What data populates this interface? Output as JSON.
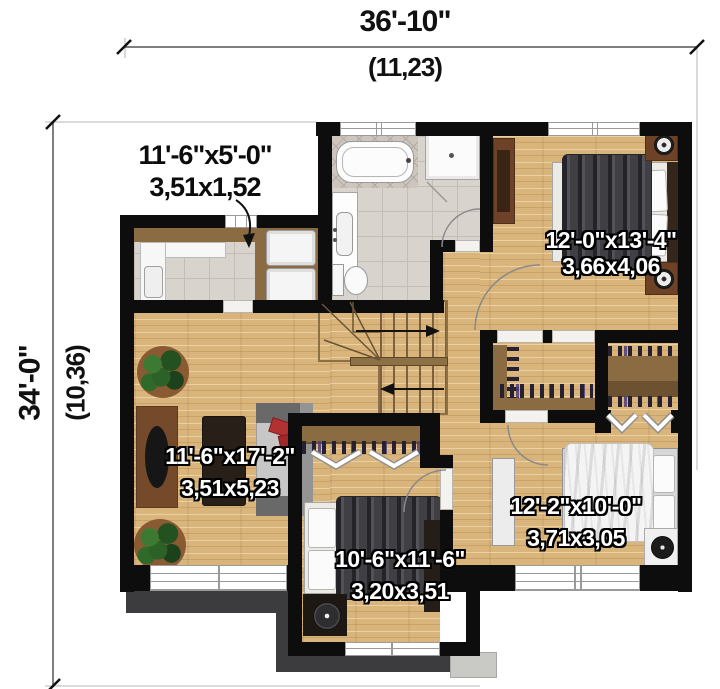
{
  "dimensions": {
    "top": {
      "imperial": "36'-10\"",
      "metric": "(11,23)"
    },
    "left": {
      "imperial": "34'-0\"",
      "metric": "(10,36)"
    }
  },
  "rooms": {
    "laundry": {
      "imperial": "11'-6\"x5'-0\"",
      "metric": "3,51x1,52"
    },
    "bedroom_top_right": {
      "imperial": "12'-0\"x13'-4\"",
      "metric": "3,66x4,06"
    },
    "living": {
      "imperial": "11'-6\"x17'-2\"",
      "metric": "3,51x5,23"
    },
    "bedroom_middle": {
      "imperial": "10'-6\"x11'-6\"",
      "metric": "3,20x3,51"
    },
    "bedroom_bottom_right": {
      "imperial": "12'-2\"x10'-0\"",
      "metric": "3,71x3,05"
    }
  },
  "colors": {
    "wall": "#0d0d0d",
    "wood_floor": "#d9b47b",
    "tile_floor": "#d8d3cd",
    "porch_ro of": "#3c3c3e",
    "closet_wood": "#8a6b42",
    "room_label_text": "#ffffff",
    "dimension_text": "#111111"
  }
}
